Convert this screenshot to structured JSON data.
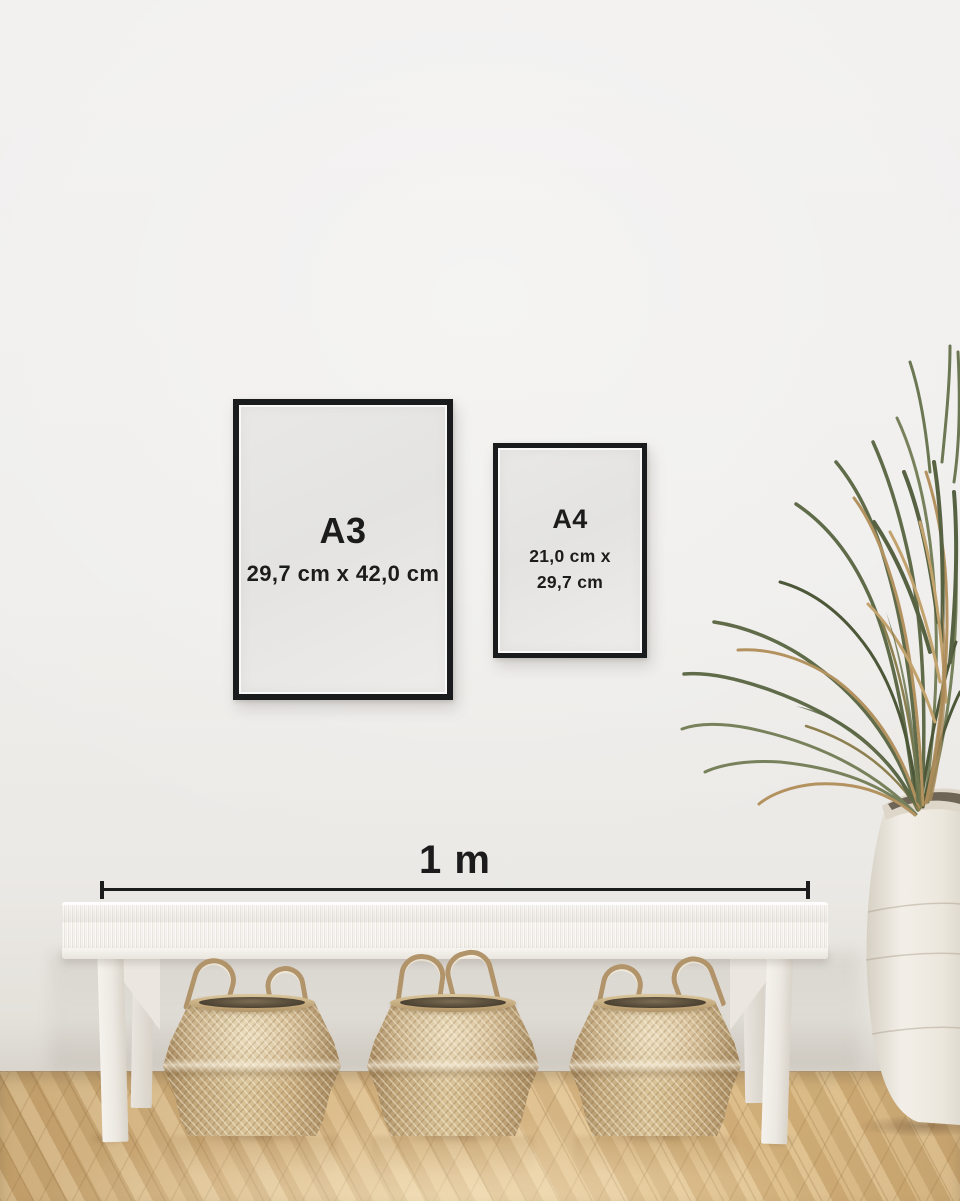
{
  "frames": [
    {
      "label": "A3",
      "dimensions": "29,7 cm x 42,0 cm"
    },
    {
      "label": "A4",
      "dimensions_line1": "21,0 cm x",
      "dimensions_line2": "29,7 cm"
    }
  ],
  "scale_bar": {
    "label": "1 m"
  },
  "colors": {
    "wall": "#efeeec",
    "floor": "#dec08f",
    "frame_border": "#1a1b1d",
    "paper": "#e4e3e1",
    "text": "#1c1c1c",
    "bench": "#f5f3ef",
    "basket": "#c7ac80",
    "rope": "#b2946a",
    "leaf_green": "#5f6b49",
    "leaf_dried": "#b3925f",
    "vase": "#efebe3"
  }
}
